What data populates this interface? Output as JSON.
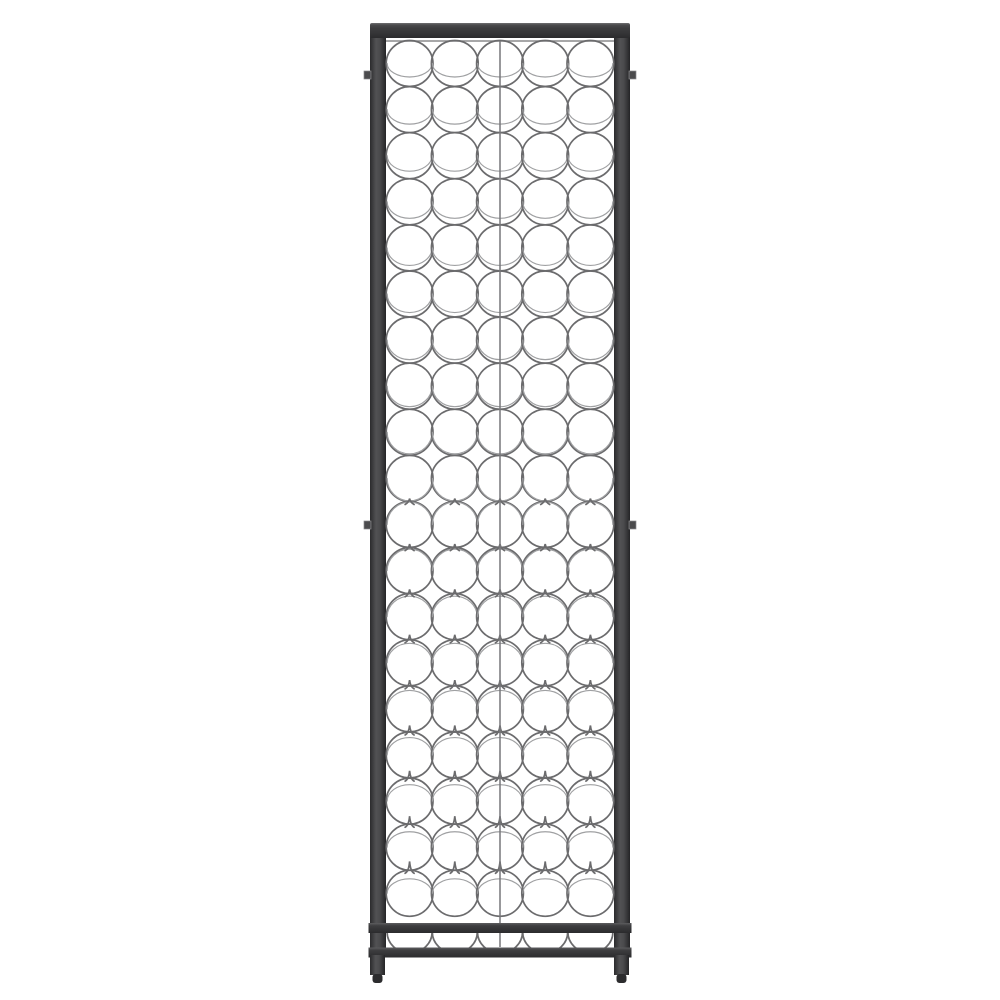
{
  "scene": {
    "type": "product-photo",
    "subject": "wall-mounted wrought-iron wine rack, front view, holds wine bottles in wire rings",
    "background_color": "#ffffff"
  },
  "colors": {
    "frame_dark": "#2b2b2d",
    "frame_mid": "#3d3d3f",
    "frame_deep": "#303032",
    "frame_light": "#6f6f71",
    "wire": "#6b6b6d",
    "wire_light": "#9fa0a2",
    "seam": "#77777a",
    "tab": "#4b4b4d",
    "foot": "#2c2c2e"
  },
  "rack": {
    "left": 370,
    "right": 630,
    "top": 23,
    "top_bar_height": 15,
    "post_width": 16,
    "inner_top_wire_y": 41,
    "center_seam_x": 500,
    "seam_top": 41,
    "seam_bottom": 947,
    "rings": {
      "rows": 19,
      "cols": 5,
      "radius_x": 23.4,
      "radius_y": 23.0,
      "first_row_cy": 63.5,
      "row_spacing": 46.1,
      "first_col_cx": 409.6,
      "col_spacing": 45.2,
      "perspective_center_y": 500,
      "perspective_range": 437,
      "max_rim_flatten": 9.5,
      "max_cusp_height": 7
    },
    "bottom": {
      "rail1_y": 923,
      "rail2_y": 947.5,
      "rail_height": 10,
      "rail_overhang": 1.5,
      "saddle_cy": 932,
      "saddle_rx": 22.5,
      "saddle_ry": 21,
      "legs_top": 957,
      "legs_bottom": 975,
      "foot_bottom": 983,
      "foot_inset": 2.5
    },
    "tabs": {
      "width": 7,
      "height": 8,
      "ys": [
        71,
        521
      ]
    }
  }
}
